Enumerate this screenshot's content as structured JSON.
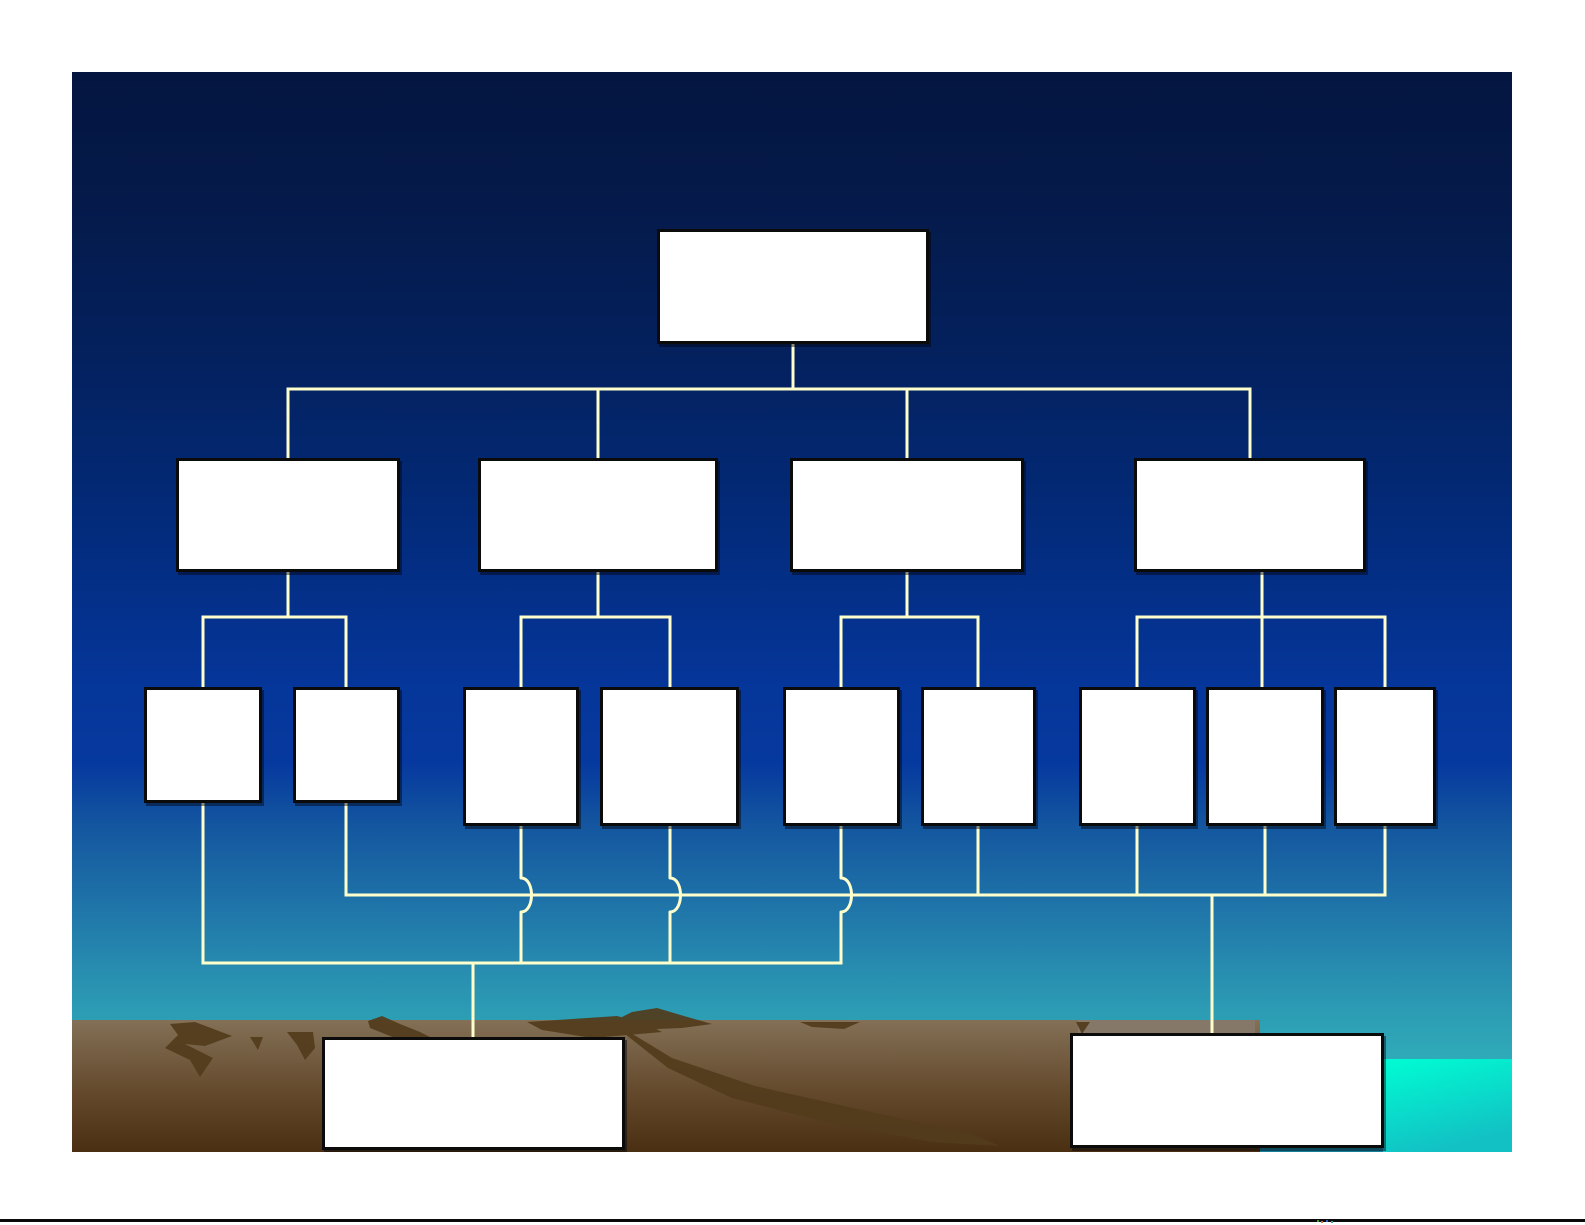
{
  "slide": {
    "kind": "blank-organization-chart",
    "nodes": {
      "level1": [
        {
          "label": ""
        }
      ],
      "level2": [
        {
          "label": ""
        },
        {
          "label": ""
        },
        {
          "label": ""
        },
        {
          "label": ""
        }
      ],
      "level3": [
        {
          "label": ""
        },
        {
          "label": ""
        },
        {
          "label": ""
        },
        {
          "label": ""
        },
        {
          "label": ""
        },
        {
          "label": ""
        },
        {
          "label": ""
        },
        {
          "label": ""
        },
        {
          "label": ""
        }
      ],
      "summary": [
        {
          "label": ""
        },
        {
          "label": ""
        }
      ]
    },
    "colors": {
      "background_top": "#041540",
      "background_royal_blue": "#053598",
      "background_teal": "#2fa9b8",
      "connector": "#ffffcc",
      "node_fill": "#ffffff",
      "node_border": "#0b0b0b",
      "land_top": "#837056",
      "land_bottom": "#4a2f12",
      "land_silhouette": "#523c1c",
      "land_light_band": "#867869",
      "water_block_top": "#00fdd3",
      "water_block_bottom": "#12c1c4",
      "footer_line": "#0a0a0a",
      "footer_marks": [
        "#3a9e3a",
        "#d4722a",
        "#3a57c9",
        "#3aa0a0"
      ]
    }
  }
}
